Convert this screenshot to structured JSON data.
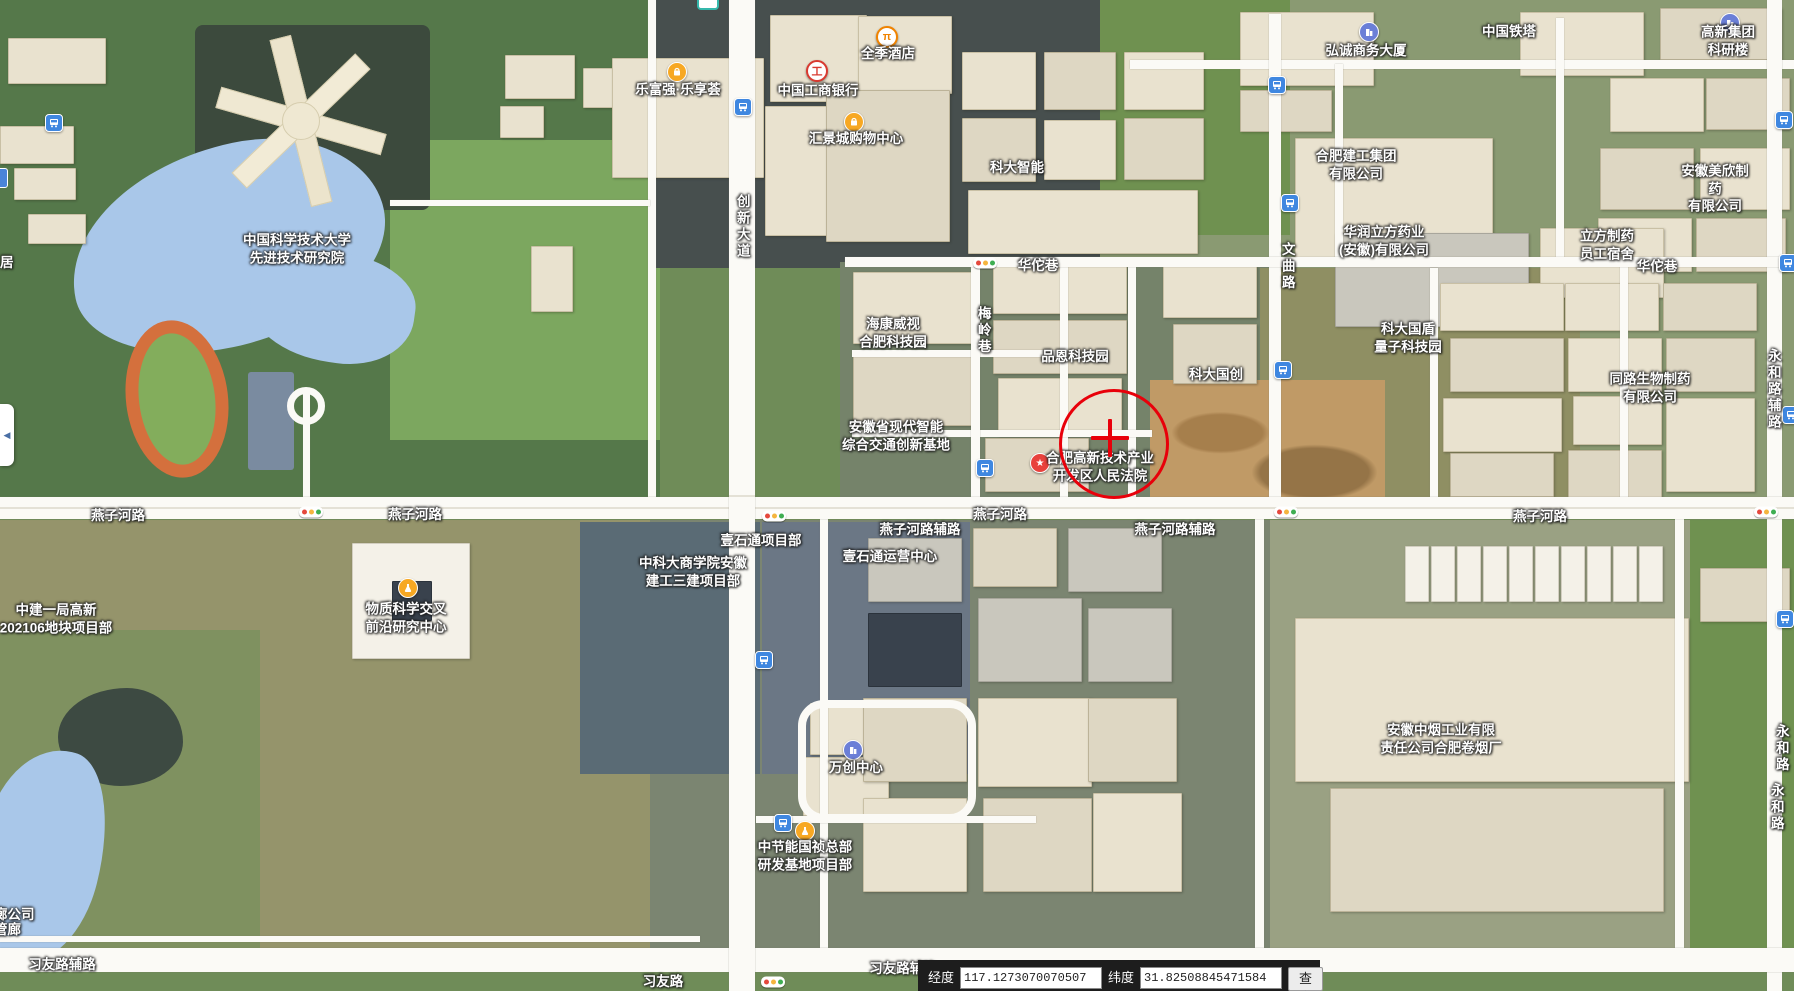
{
  "app": {
    "type": "satellite-map-view",
    "region": "合肥高新技术产业开发区"
  },
  "colors": {
    "marker_red": "#e8000a",
    "water": "#a9c7e9",
    "road_white": "#fbfaf6",
    "icon_orange": "#f7a823",
    "icon_blue": "#3f87e0",
    "icon_purple": "#6b7fd7",
    "icon_red": "#e8413c"
  },
  "collapse_button": {
    "glyph": "◀"
  },
  "marker": {
    "x": 1111,
    "y": 441,
    "radius": 52,
    "crosshair_x": 1110,
    "crosshair_y": 438
  },
  "coord_bar": {
    "lng_label": "经度",
    "lng_value": "117.1273070070507",
    "lat_label": "纬度",
    "lat_value": "31.82508845471584",
    "search_label": "查询"
  },
  "labels": [
    {
      "name": "label-ustc-advanced-institute",
      "text": "中国科学技术大学\n先进技术研究院",
      "x": 297,
      "y": 249,
      "kind": "poi"
    },
    {
      "name": "label-lefuqiang-plaza",
      "text": "乐富强·乐享荟",
      "x": 678,
      "y": 90,
      "kind": "poi"
    },
    {
      "name": "label-icbc-bank",
      "text": "中国工商银行",
      "x": 818,
      "y": 91,
      "kind": "poi"
    },
    {
      "name": "label-quanji-hotel",
      "text": "全季酒店",
      "x": 888,
      "y": 54,
      "kind": "poi"
    },
    {
      "name": "label-huijingcheng-mall",
      "text": "汇景城购物中心",
      "x": 856,
      "y": 139,
      "kind": "poi"
    },
    {
      "name": "label-keda-zhineng",
      "text": "科大智能",
      "x": 1017,
      "y": 168,
      "kind": "poi"
    },
    {
      "name": "label-hongcheng-tower",
      "text": "弘诚商务大厦",
      "x": 1366,
      "y": 51,
      "kind": "poi"
    },
    {
      "name": "label-china-tower",
      "text": "中国铁塔",
      "x": 1509,
      "y": 32,
      "kind": "poi"
    },
    {
      "name": "label-gaoxin-group-research",
      "text": "高新集团科研楼",
      "x": 1728,
      "y": 41,
      "kind": "poi"
    },
    {
      "name": "label-hefei-jiangong-group",
      "text": "合肥建工集团\n有限公司",
      "x": 1356,
      "y": 165,
      "kind": "poi"
    },
    {
      "name": "label-huarun-lifang-pharma",
      "text": "华润立方药业\n(安徽)有限公司",
      "x": 1384,
      "y": 241,
      "kind": "poi"
    },
    {
      "name": "label-lifang-dormitory",
      "text": "立方制药\n员工宿舍",
      "x": 1607,
      "y": 245,
      "kind": "poi"
    },
    {
      "name": "label-meixin-pharma",
      "text": "安徽美欣制药\n有限公司",
      "x": 1715,
      "y": 189,
      "kind": "poi"
    },
    {
      "name": "label-hikvision-park",
      "text": "海康威视\n合肥科技园",
      "x": 893,
      "y": 333,
      "kind": "poi"
    },
    {
      "name": "label-pinen-tech-park",
      "text": "品恩科技园",
      "x": 1075,
      "y": 357,
      "kind": "poi"
    },
    {
      "name": "label-keda-guochuang",
      "text": "科大国创",
      "x": 1216,
      "y": 375,
      "kind": "poi"
    },
    {
      "name": "label-keda-guodun-quantum",
      "text": "科大国盾\n量子科技园",
      "x": 1408,
      "y": 338,
      "kind": "poi"
    },
    {
      "name": "label-tonglu-bio-pharma",
      "text": "同路生物制药\n有限公司",
      "x": 1650,
      "y": 388,
      "kind": "poi"
    },
    {
      "name": "label-anhui-transport-base",
      "text": "安徽省现代智能\n综合交通创新基地",
      "x": 896,
      "y": 436,
      "kind": "poi"
    },
    {
      "name": "label-hightech-court",
      "text": "合肥高新技术产业\n开发区人民法院",
      "x": 1100,
      "y": 467,
      "kind": "poi"
    },
    {
      "name": "label-zhongjian-bureau-project",
      "text": "中建一局高新\n202106地块项目部",
      "x": 56,
      "y": 619,
      "kind": "poi"
    },
    {
      "name": "label-matter-science-center",
      "text": "物质科学交叉\n前沿研究中心",
      "x": 406,
      "y": 618,
      "kind": "poi"
    },
    {
      "name": "label-ustc-business-school-project",
      "text": "中科大商学院安徽\n建工三建项目部",
      "x": 693,
      "y": 572,
      "kind": "poi"
    },
    {
      "name": "label-yishitong-project",
      "text": "壹石通项目部",
      "x": 761,
      "y": 541,
      "kind": "poi"
    },
    {
      "name": "label-yishitong-operations",
      "text": "壹石通运营中心",
      "x": 890,
      "y": 557,
      "kind": "poi"
    },
    {
      "name": "label-wanchuang-center",
      "text": "万创中心",
      "x": 856,
      "y": 768,
      "kind": "poi"
    },
    {
      "name": "label-zhongjieneng-hq",
      "text": "中节能国祯总部\n研发基地项目部",
      "x": 805,
      "y": 856,
      "kind": "poi"
    },
    {
      "name": "label-tobacco-factory",
      "text": "安徽中烟工业有限\n责任公司合肥卷烟厂",
      "x": 1441,
      "y": 739,
      "kind": "poi"
    },
    {
      "name": "label-ju-partial",
      "text": "居",
      "x": 0,
      "y": 263,
      "kind": "poi",
      "anchor": "left"
    },
    {
      "name": "label-langgongsi-partial",
      "text": "廊公司",
      "x": -6,
      "y": 915,
      "kind": "poi",
      "anchor": "left"
    },
    {
      "name": "label-guanlang-partial",
      "text": "管廊",
      "x": -6,
      "y": 930,
      "kind": "poi",
      "anchor": "left"
    },
    {
      "name": "label-road-huatuo-lane-1",
      "text": "华佗巷",
      "x": 1038,
      "y": 266,
      "kind": "road"
    },
    {
      "name": "label-road-huatuo-lane-2",
      "text": "华佗巷",
      "x": 1657,
      "y": 267,
      "kind": "road"
    },
    {
      "name": "label-road-yanzihe-1",
      "text": "燕子河路",
      "x": 118,
      "y": 516,
      "kind": "road"
    },
    {
      "name": "label-road-yanzihe-2",
      "text": "燕子河路",
      "x": 415,
      "y": 515,
      "kind": "road"
    },
    {
      "name": "label-road-yanzihe-3",
      "text": "燕子河路",
      "x": 1000,
      "y": 515,
      "kind": "road"
    },
    {
      "name": "label-road-yanzihe-4",
      "text": "燕子河路",
      "x": 1540,
      "y": 517,
      "kind": "road"
    },
    {
      "name": "label-road-yanzihe-fulu-1",
      "text": "燕子河路辅路",
      "x": 920,
      "y": 530,
      "kind": "road"
    },
    {
      "name": "label-road-yanzihe-fulu-2",
      "text": "燕子河路辅路",
      "x": 1175,
      "y": 530,
      "kind": "road"
    },
    {
      "name": "label-road-xiyou",
      "text": "习友路",
      "x": 663,
      "y": 982,
      "kind": "road"
    },
    {
      "name": "label-road-xiyou-fulu-1",
      "text": "习友路辅路",
      "x": 62,
      "y": 965,
      "kind": "road"
    },
    {
      "name": "label-road-xiyou-fulu-2",
      "text": "习友路辅路",
      "x": 903,
      "y": 969,
      "kind": "road"
    },
    {
      "name": "label-road-chuangxin-avenue",
      "text": "创新大道",
      "x": 742,
      "y": 227,
      "kind": "vroad"
    },
    {
      "name": "label-road-wenqu",
      "text": "文曲路",
      "x": 1287,
      "y": 267,
      "kind": "vroad"
    },
    {
      "name": "label-road-meiling-lane",
      "text": "梅岭巷",
      "x": 983,
      "y": 331,
      "kind": "vroad"
    },
    {
      "name": "label-road-yonghe-fulu",
      "text": "永和路辅路",
      "x": 1773,
      "y": 390,
      "kind": "vroad"
    },
    {
      "name": "label-road-yonghe-1",
      "text": "永和路",
      "x": 1781,
      "y": 749,
      "kind": "vroad"
    },
    {
      "name": "label-road-yonghe-2",
      "text": "永和路",
      "x": 1776,
      "y": 808,
      "kind": "vroad"
    }
  ],
  "icons": [
    {
      "name": "bus-stop-icon-1",
      "type": "bus",
      "x": 54,
      "y": 123
    },
    {
      "name": "bus-stop-icon-2",
      "type": "bus",
      "x": 743,
      "y": 107
    },
    {
      "name": "bus-stop-icon-3",
      "type": "bus",
      "x": 1277,
      "y": 85
    },
    {
      "name": "bus-stop-icon-4",
      "type": "bus",
      "x": 1290,
      "y": 203
    },
    {
      "name": "bus-stop-icon-5",
      "type": "bus",
      "x": 985,
      "y": 468
    },
    {
      "name": "bus-stop-icon-6",
      "type": "bus",
      "x": 764,
      "y": 660
    },
    {
      "name": "bus-stop-icon-7",
      "type": "bus",
      "x": 783,
      "y": 823
    },
    {
      "name": "bus-stop-icon-8",
      "type": "bus",
      "x": 1283,
      "y": 370
    },
    {
      "name": "bus-stop-icon-9",
      "type": "bus",
      "x": 1784,
      "y": 120
    },
    {
      "name": "bus-stop-icon-10",
      "type": "bus",
      "x": 1788,
      "y": 263
    },
    {
      "name": "bus-stop-icon-11",
      "type": "bus",
      "x": 1791,
      "y": 415
    },
    {
      "name": "bus-stop-icon-12",
      "type": "bus",
      "x": 1785,
      "y": 619
    },
    {
      "name": "shopping-bag-icon-1",
      "type": "bag",
      "x": 677,
      "y": 72
    },
    {
      "name": "shopping-bag-icon-2",
      "type": "bag",
      "x": 854,
      "y": 122
    },
    {
      "name": "icbc-bank-icon",
      "type": "icbc",
      "x": 817,
      "y": 71
    },
    {
      "name": "hotel-icon",
      "type": "hotel",
      "x": 887,
      "y": 37
    },
    {
      "name": "office-building-icon-1",
      "type": "building",
      "x": 1369,
      "y": 32
    },
    {
      "name": "office-building-icon-2",
      "type": "building",
      "x": 1730,
      "y": 23
    },
    {
      "name": "office-building-icon-3",
      "type": "building",
      "x": 853,
      "y": 750
    },
    {
      "name": "research-flask-icon-1",
      "type": "flask",
      "x": 408,
      "y": 588
    },
    {
      "name": "research-flask-icon-2",
      "type": "flask",
      "x": 805,
      "y": 831
    },
    {
      "name": "court-star-icon",
      "type": "court",
      "x": 1040,
      "y": 463
    },
    {
      "name": "traffic-light-icon-1",
      "type": "light",
      "x": 985,
      "y": 263
    },
    {
      "name": "traffic-light-icon-2",
      "type": "light",
      "x": 311,
      "y": 512
    },
    {
      "name": "traffic-light-icon-3",
      "type": "light",
      "x": 774,
      "y": 516
    },
    {
      "name": "traffic-light-icon-4",
      "type": "light",
      "x": 1286,
      "y": 512
    },
    {
      "name": "traffic-light-icon-5",
      "type": "light",
      "x": 1766,
      "y": 512
    },
    {
      "name": "traffic-light-icon-6",
      "type": "light",
      "x": 773,
      "y": 982
    },
    {
      "name": "metro-station-icon-partial",
      "type": "metro",
      "x": 708,
      "y": 2
    },
    {
      "name": "poi-icon-partial-left",
      "type": "partialblue",
      "x": 1,
      "y": 178
    }
  ]
}
